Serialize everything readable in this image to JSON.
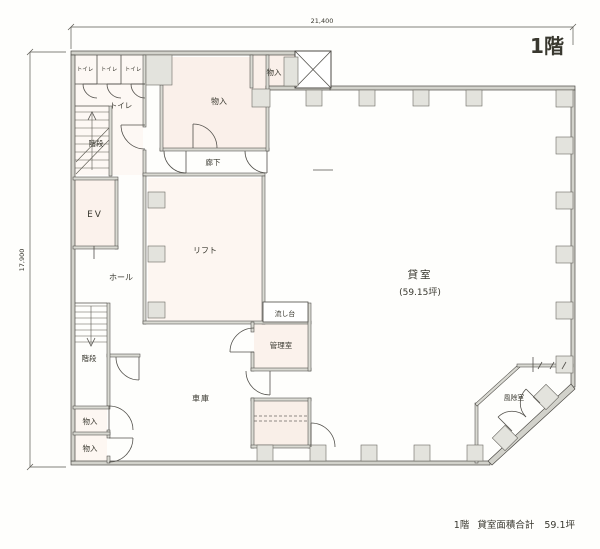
{
  "floor_plan": {
    "floor_label": "1階",
    "dimensions": {
      "width": "21,400",
      "height": "17,900"
    },
    "rooms": {
      "toilet": "トイレ",
      "stairs": "階段",
      "storage": "物入",
      "corridor": "廊下",
      "elevator": "EV",
      "hall": "ホール",
      "lift": "リフト",
      "rental": "貸室",
      "rental_area": "(59.15坪)",
      "sink": "流し台",
      "manager": "管理室",
      "garage": "車庫",
      "vestibule": "風除室"
    },
    "footer": {
      "floor": "1階",
      "label": "貸室面積合計",
      "value": "59.1坪"
    }
  }
}
